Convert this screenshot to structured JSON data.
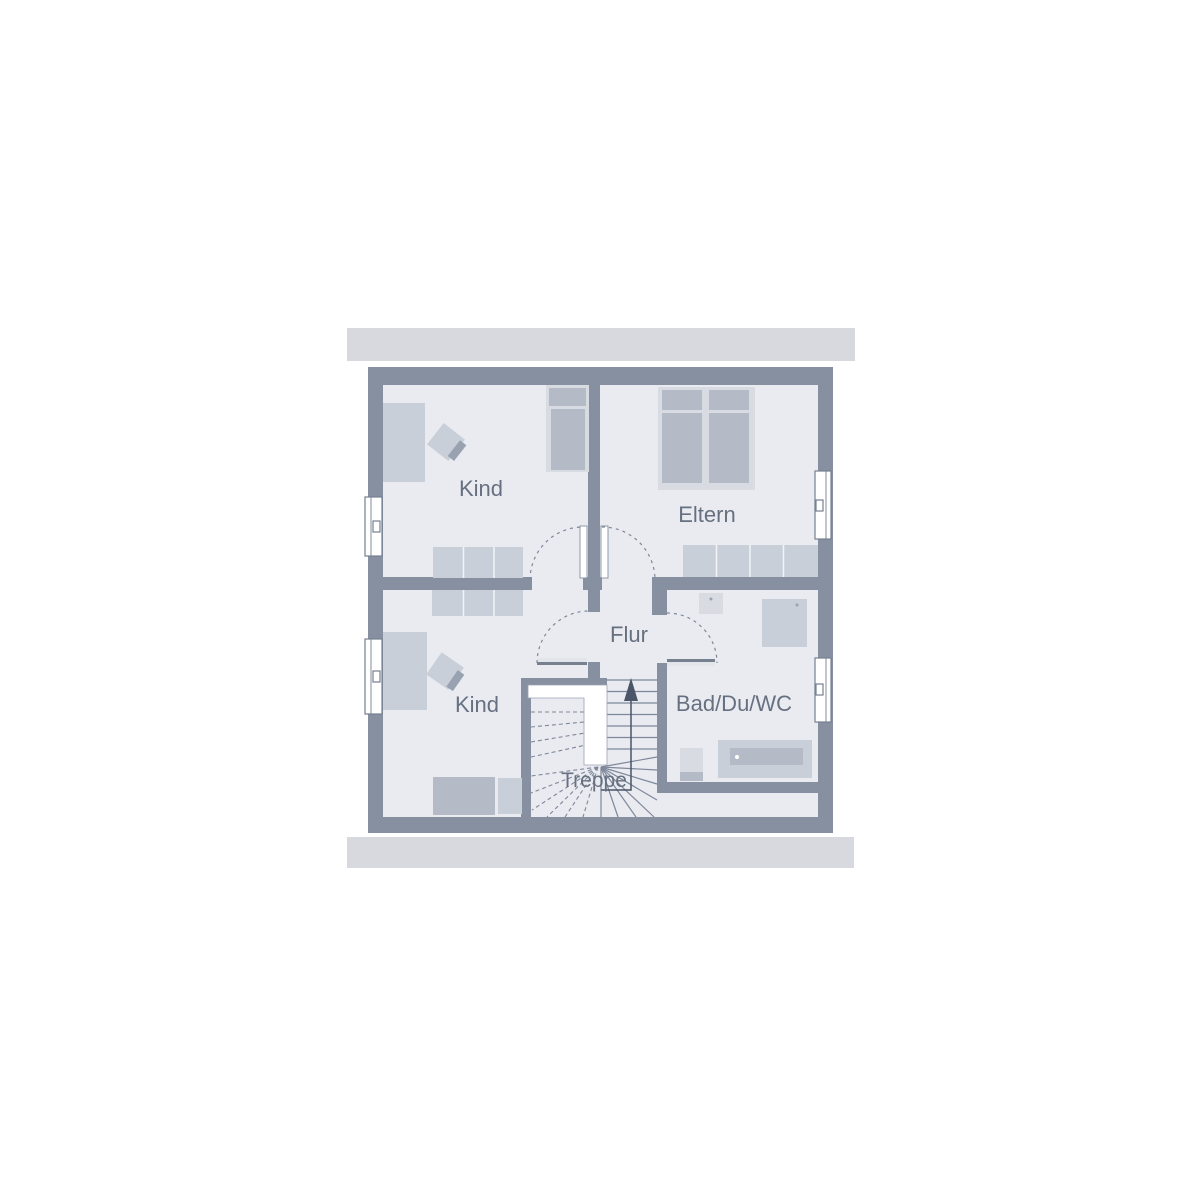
{
  "plan": {
    "rooms": [
      {
        "id": "kind_top",
        "label": "Kind"
      },
      {
        "id": "eltern",
        "label": "Eltern"
      },
      {
        "id": "kind_bottom",
        "label": "Kind"
      },
      {
        "id": "flur",
        "label": "Flur"
      },
      {
        "id": "bad",
        "label": "Bad/Du/WC"
      },
      {
        "id": "treppe",
        "label": "Treppe"
      }
    ],
    "palette": {
      "wall": "#8690a0",
      "floor": "#e9ebf1",
      "band": "#d7d9de",
      "furn_light": "#d8dbe1",
      "furn_mid": "#c9cfd8",
      "furn_dark": "#b4bbc7",
      "accent": "#99a2b1",
      "line": "#7e8899",
      "leaf_dark": "#76808f",
      "leaf_light": "#e2e5ea",
      "void_stroke": "#9aa3b2",
      "text": "#677080",
      "arrow": "#4a5568"
    }
  }
}
